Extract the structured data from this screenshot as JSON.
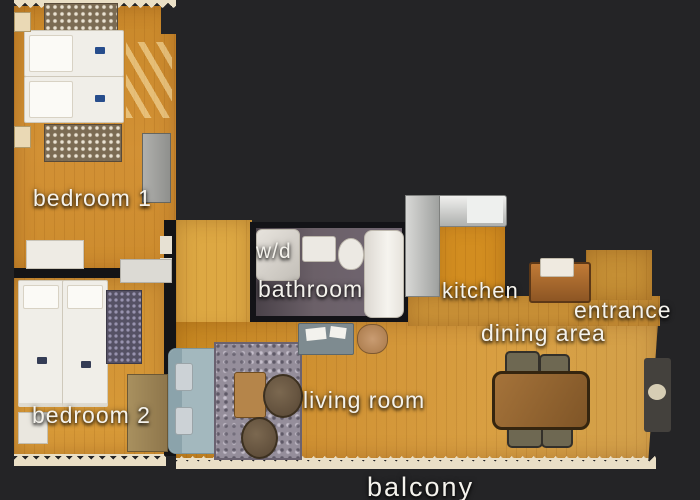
{
  "labels": {
    "bedroom1": "bedroom 1",
    "bedroom2": "bedroom 2",
    "washer_dryer": "w/d",
    "bathroom": "bathroom",
    "kitchen": "kitchen",
    "entrance": "entrance",
    "dining_area": "dining area",
    "living_room": "living room",
    "balcony": "balcony"
  },
  "colors": {
    "background": "#232324",
    "wood_floor": "#d2953a",
    "corridor_floor": "#dda843",
    "bathroom_floor": "#675d66",
    "scan_edge_fringe": "#eadfc6",
    "label_text": "#f4f2ec"
  }
}
